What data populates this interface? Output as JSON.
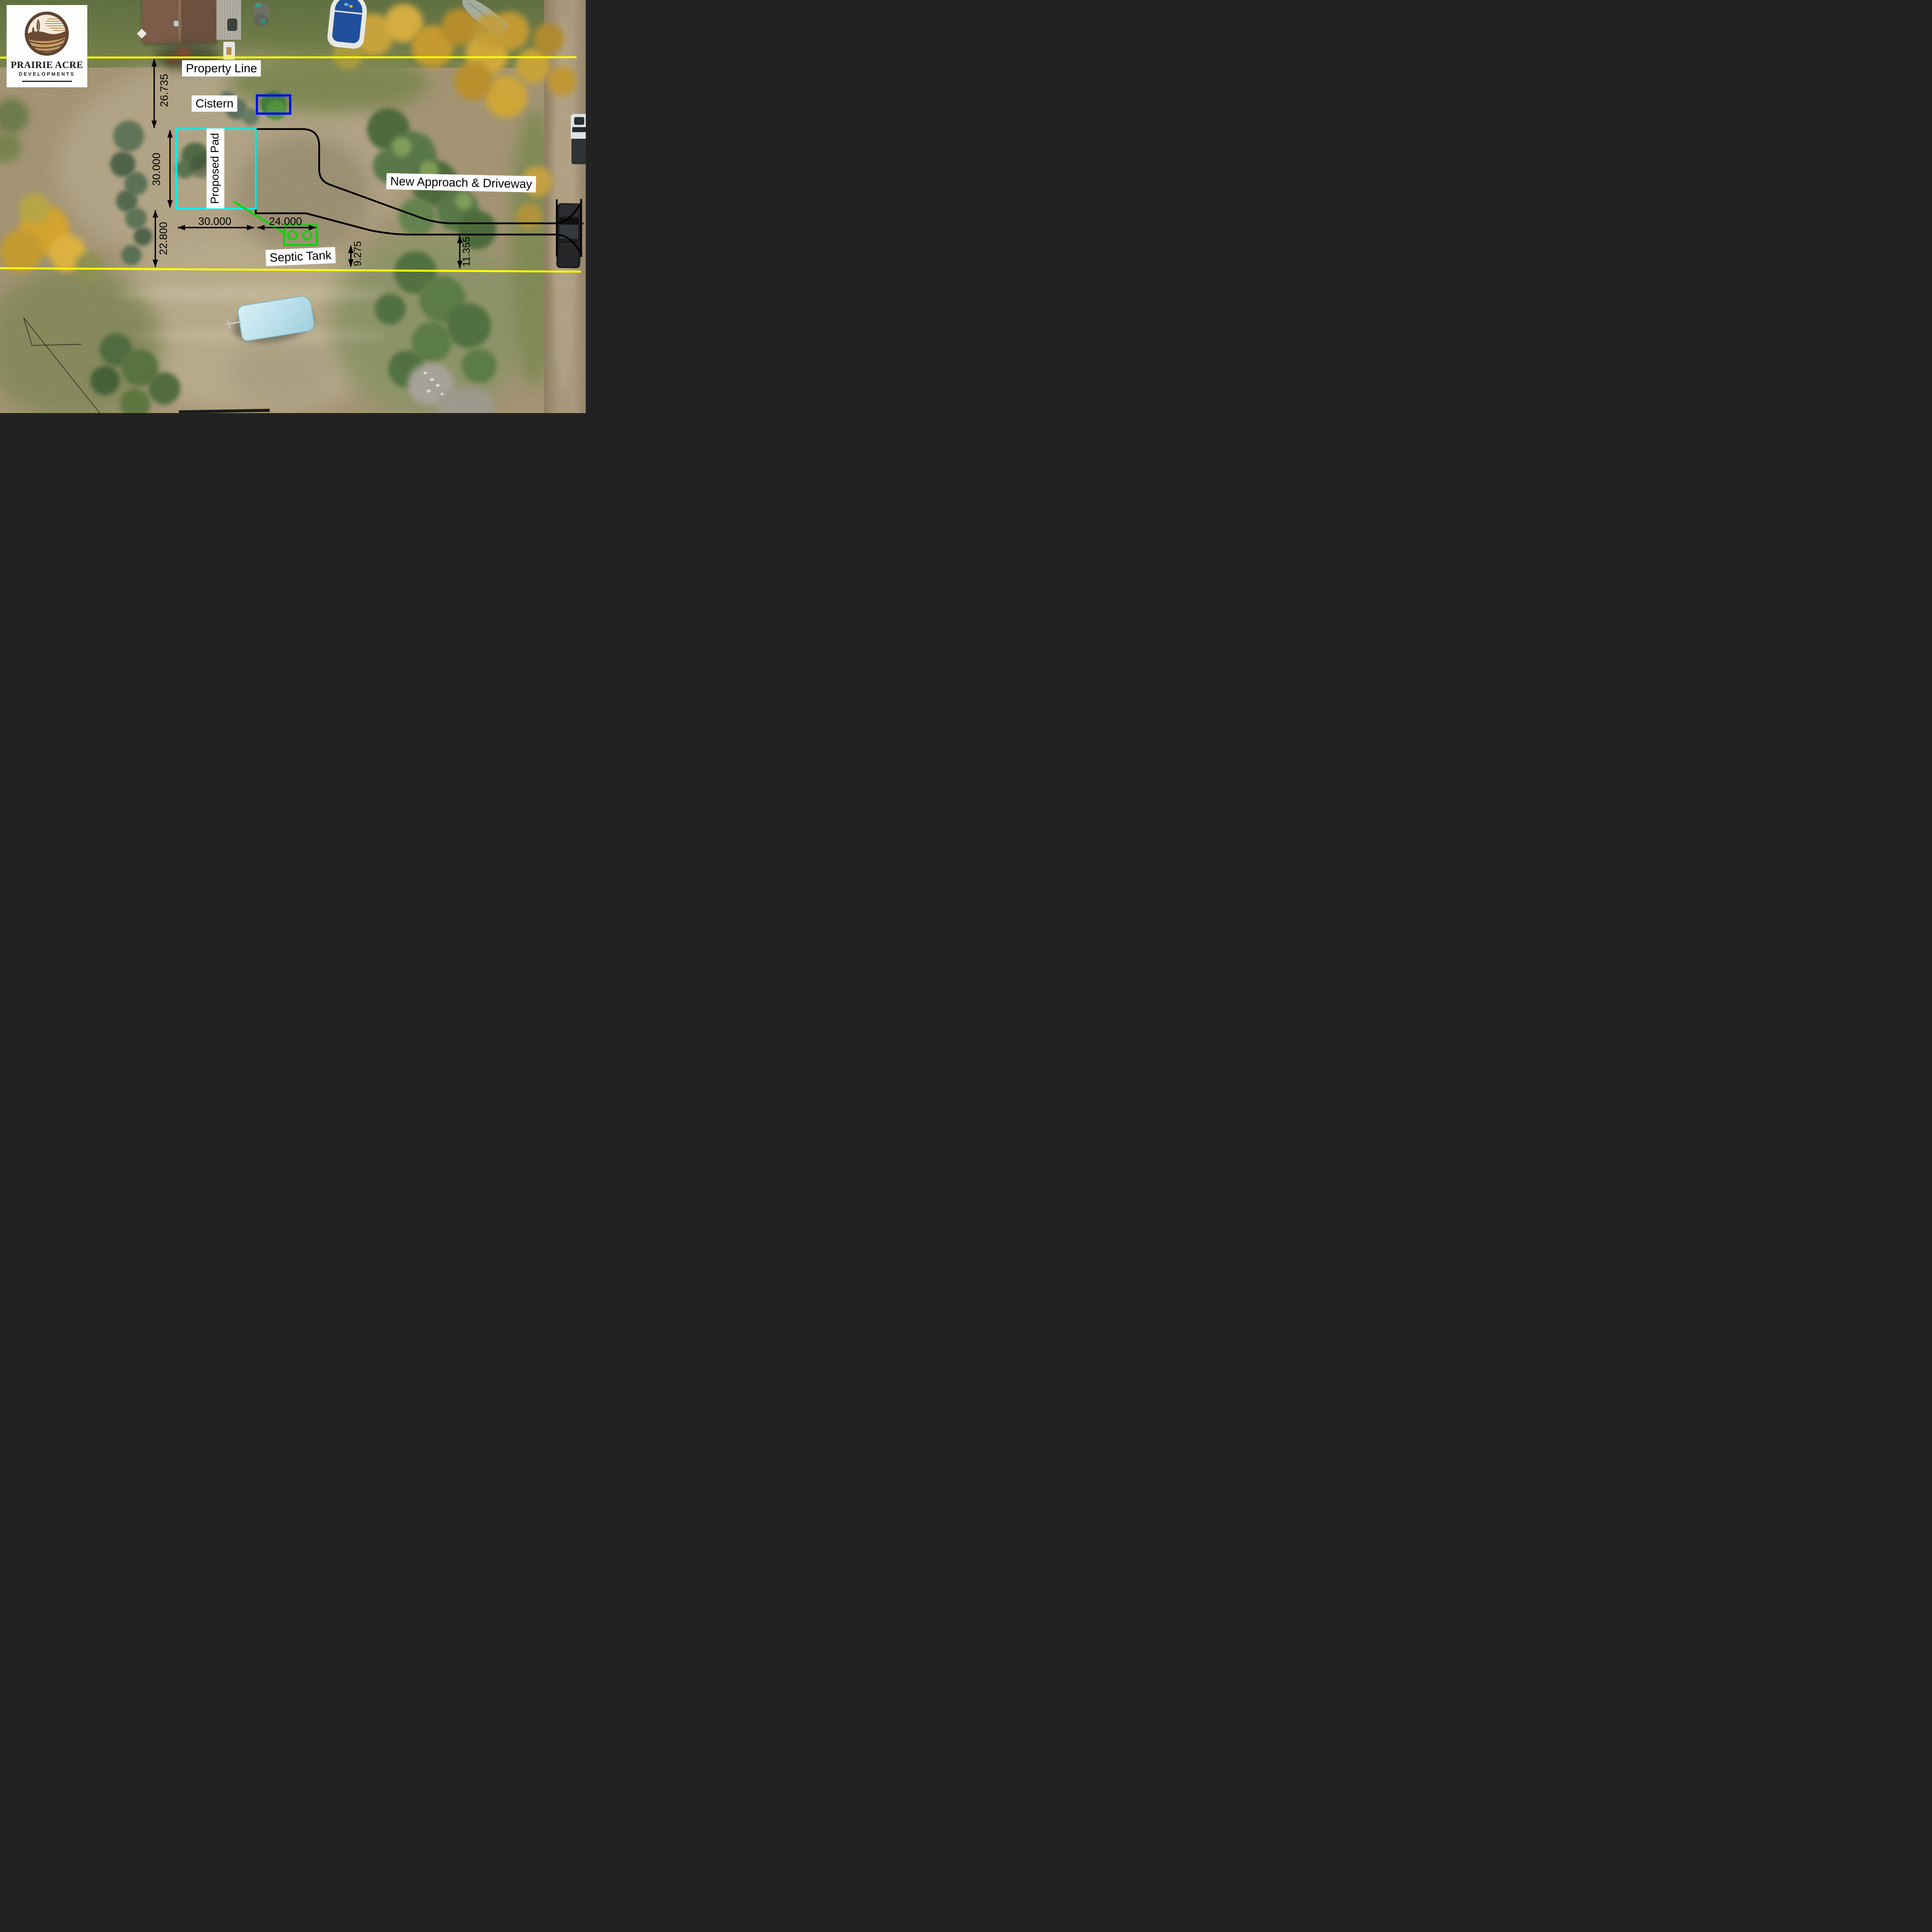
{
  "page": {
    "title": "Prairie Acre Developments — Site Plan"
  },
  "logo": {
    "title": "PRAIRIE ACRE",
    "subtitle": "DEVELOPMENTS"
  },
  "labels": {
    "property_line": "Property Line",
    "cistern": "Cistern",
    "proposed_pad": "Proposed Pad",
    "septic_tank": "Septic Tank",
    "new_approach": "New Approach & Driveway"
  },
  "dimensions": {
    "property_line_to_pad": "26.735",
    "pad_depth": "30.000",
    "pad_width": "30.000",
    "pad_to_septic_area": "24.000",
    "pad_to_south_property_line": "22.800",
    "septic_to_property_line": "9.275",
    "driveway_to_property_line": "11.355"
  },
  "colors": {
    "property_line": "#FFFF00",
    "proposed_pad": "#00F0F0",
    "cistern": "#0013E8",
    "septic": "#00D800",
    "driveway": "#000000",
    "label_bg": "#FFFFFF",
    "label_text": "#000000"
  }
}
